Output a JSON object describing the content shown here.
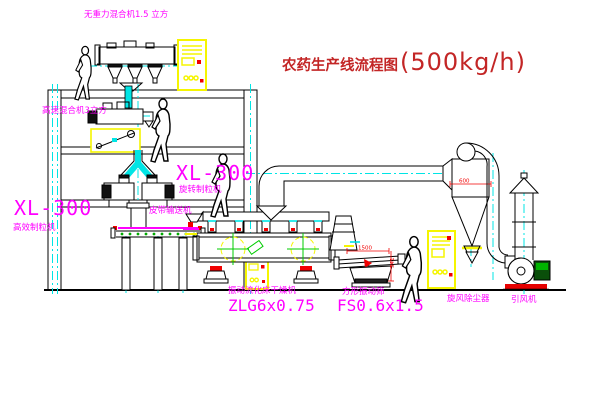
{
  "title": {
    "name": "农药生产线流程图",
    "capacity": "(500kg/h)"
  },
  "labels": {
    "mixer_top": "无重力混合机1.5 立方",
    "mixer_mid": "高速混合机3立方",
    "granulator_left_model": "XL-300",
    "granulator_left_name": "高效制粒机",
    "granulator_right_model": "XL-300",
    "granulator_right_name": "旋转制粒机",
    "belt_conveyor": "皮带输送机",
    "dryer_name": "振动流化床干燥机",
    "dryer_model": "ZLG6x0.75",
    "screen_name": "方形振动筛",
    "screen_model": "FS0.6x1.5",
    "cyclone": "旋风除尘器",
    "fan": "引风机"
  },
  "dimensions": {
    "screen_length": "1500",
    "screen_height": "541",
    "cyclone_diameter": "600"
  },
  "colors": {
    "label_magenta": "#ff00ff",
    "title_red": "#c32626",
    "centerline_cyan": "#00ffff",
    "cabinet_yellow": "#ffff00",
    "accent_red": "#ff0000",
    "machine_green": "#00bb00",
    "line_black": "#000000"
  }
}
